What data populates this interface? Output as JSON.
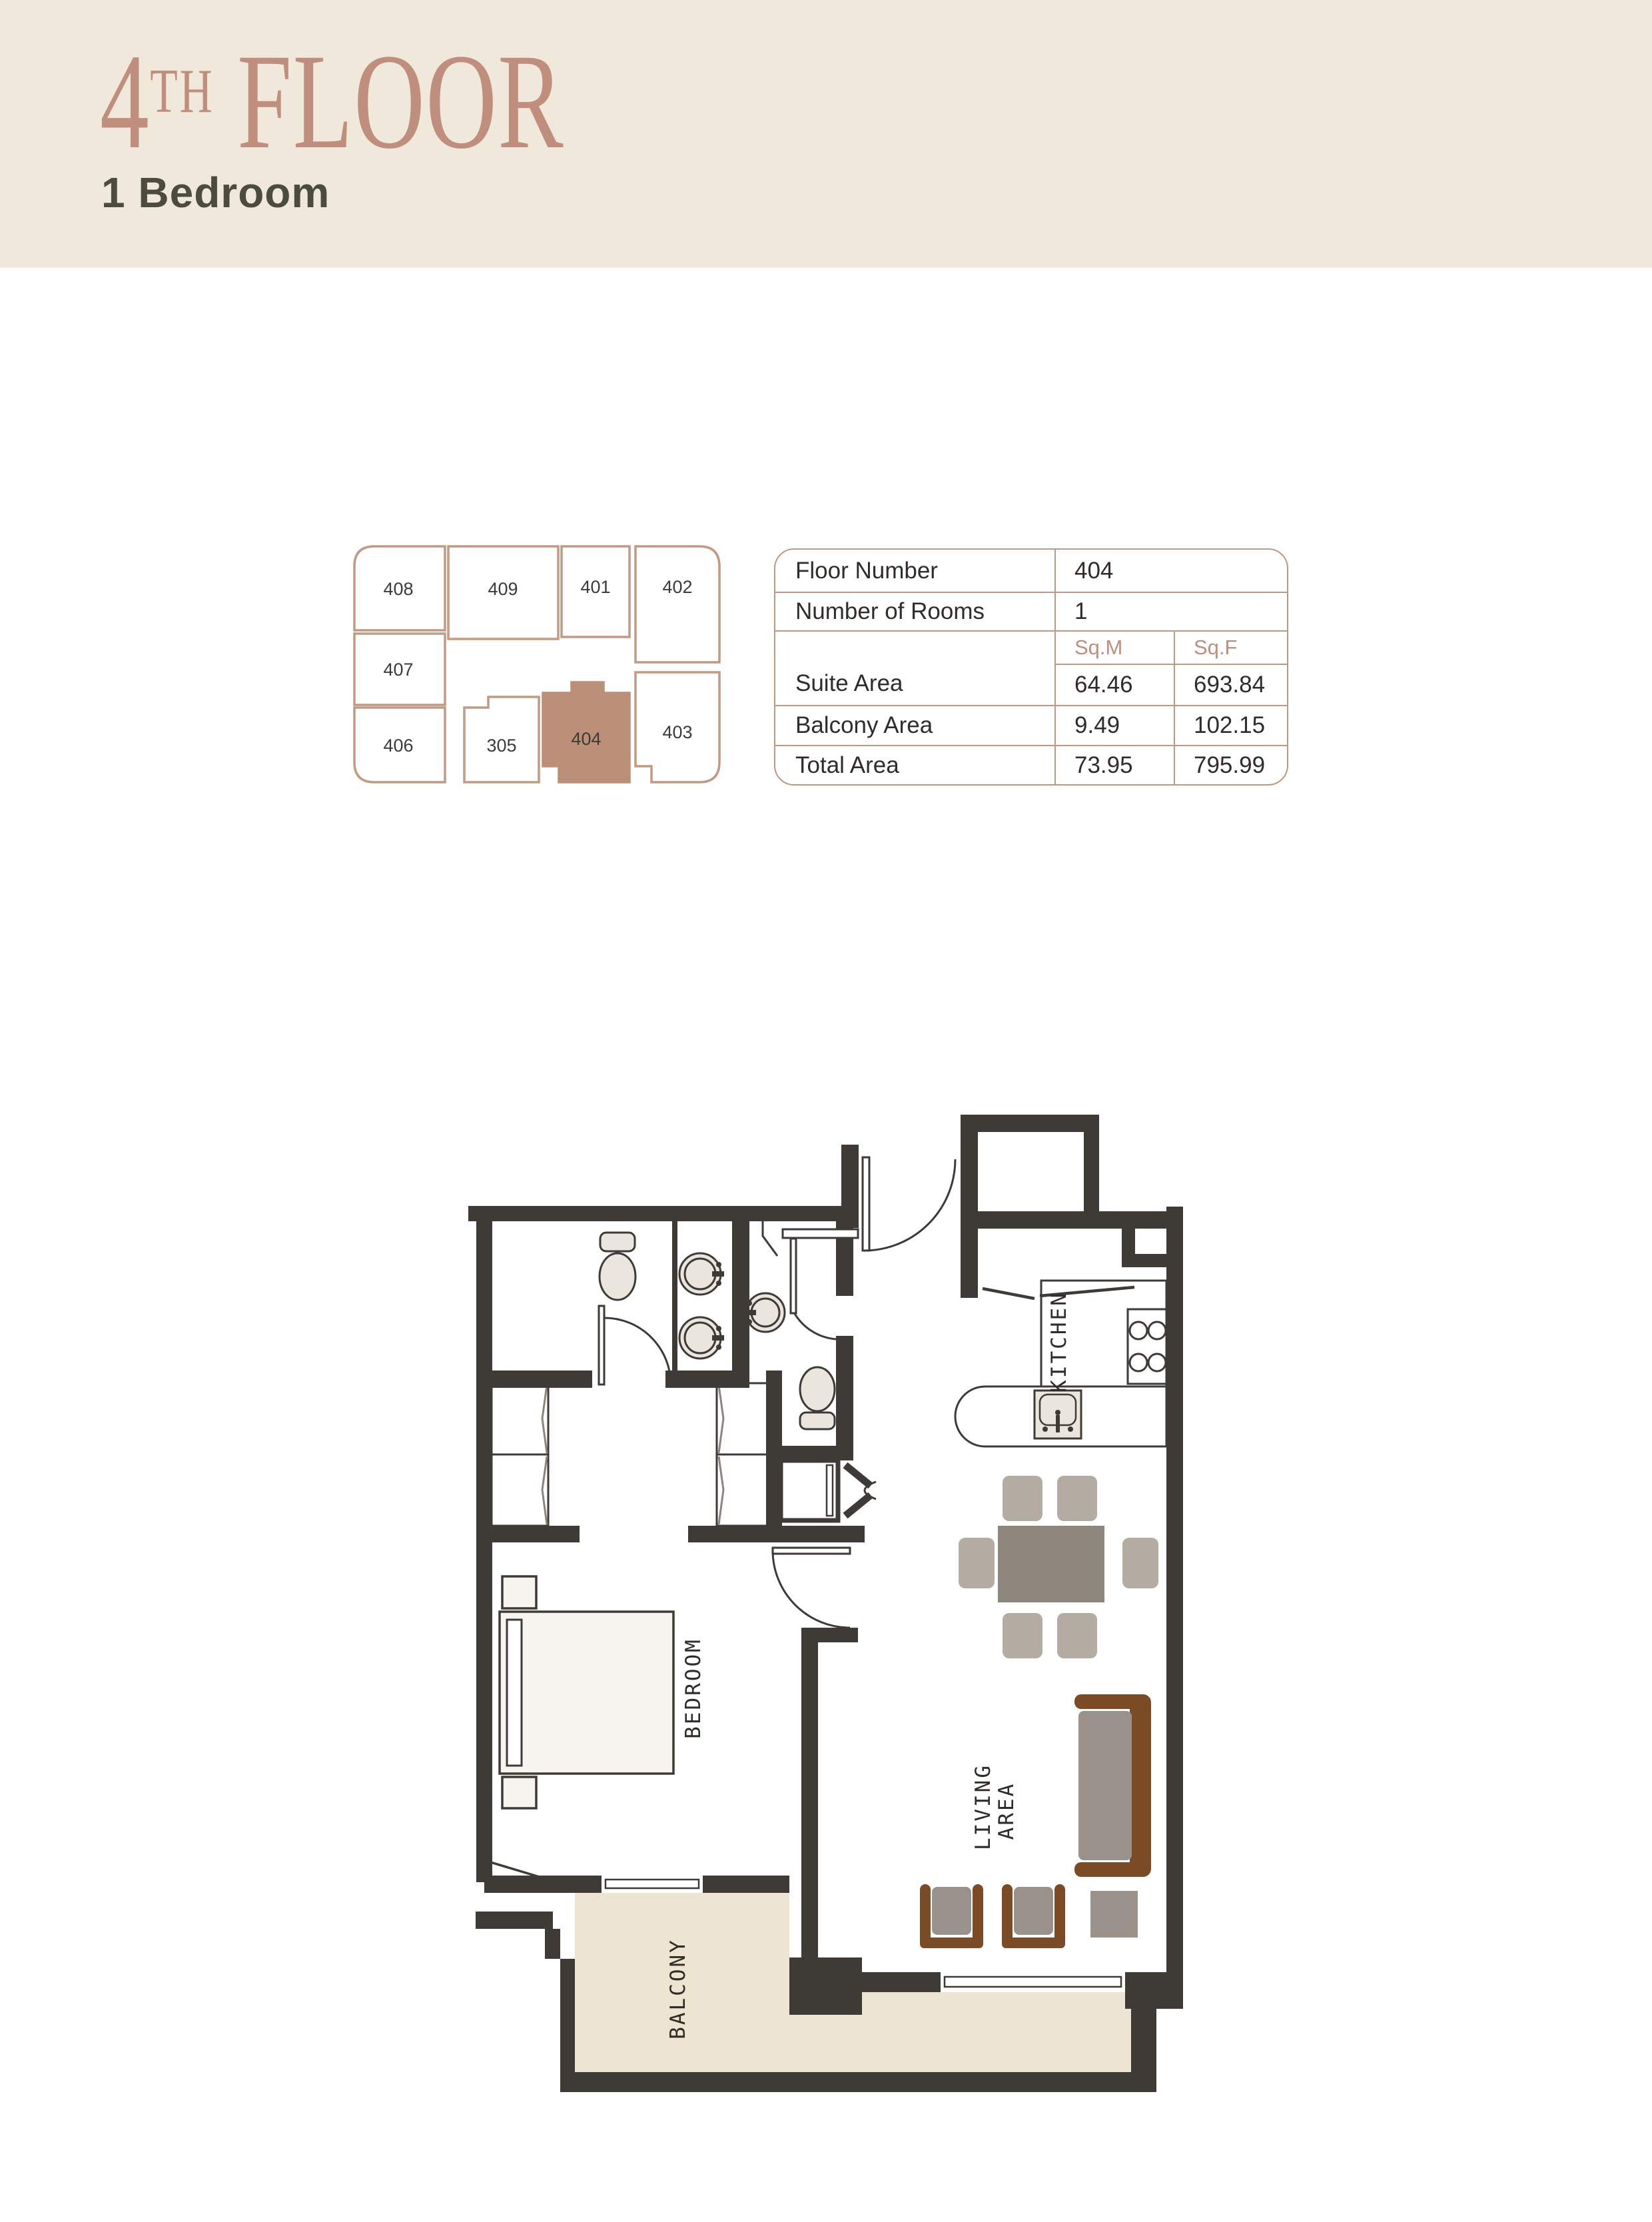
{
  "header": {
    "title_number": "4",
    "title_suffix": "TH",
    "title_word": "FLOOR",
    "subtitle": "1 Bedroom"
  },
  "keyplan": {
    "highlighted_unit": "404",
    "units": [
      {
        "id": "408"
      },
      {
        "id": "409"
      },
      {
        "id": "401"
      },
      {
        "id": "402"
      },
      {
        "id": "407"
      },
      {
        "id": "406"
      },
      {
        "id": "305"
      },
      {
        "id": "404"
      },
      {
        "id": "403"
      }
    ]
  },
  "table": {
    "floor_number_label": "Floor Number",
    "floor_number_value": "404",
    "rooms_label": "Number of Rooms",
    "rooms_value": "1",
    "col_sqm": "Sq.M",
    "col_sqf": "Sq.F",
    "suite_label": "Suite Area",
    "suite_sqm": "64.46",
    "suite_sqf": "693.84",
    "balcony_label": "Balcony Area",
    "balcony_sqm": "9.49",
    "balcony_sqf": "102.15",
    "total_label": "Total Area",
    "total_sqm": "73.95",
    "total_sqf": "795.99"
  },
  "plan": {
    "labels": {
      "kitchen": "KITCHEN",
      "bedroom": "BEDROOM",
      "living_line1": "LIVING",
      "living_line2": "AREA",
      "balcony": "BALCONY"
    }
  },
  "colors": {
    "accent": "#C08E7C",
    "subtitle_text": "#4C4C3E",
    "header_bg": "#F0E9DB",
    "wall": "#3E3A36",
    "keyplan_line": "#C29A83",
    "keyplan_highlight": "#BC8F78",
    "balcony_fill": "#EDE4D2",
    "table_border": "#C0987F",
    "text_dark": "#2F2C29"
  }
}
